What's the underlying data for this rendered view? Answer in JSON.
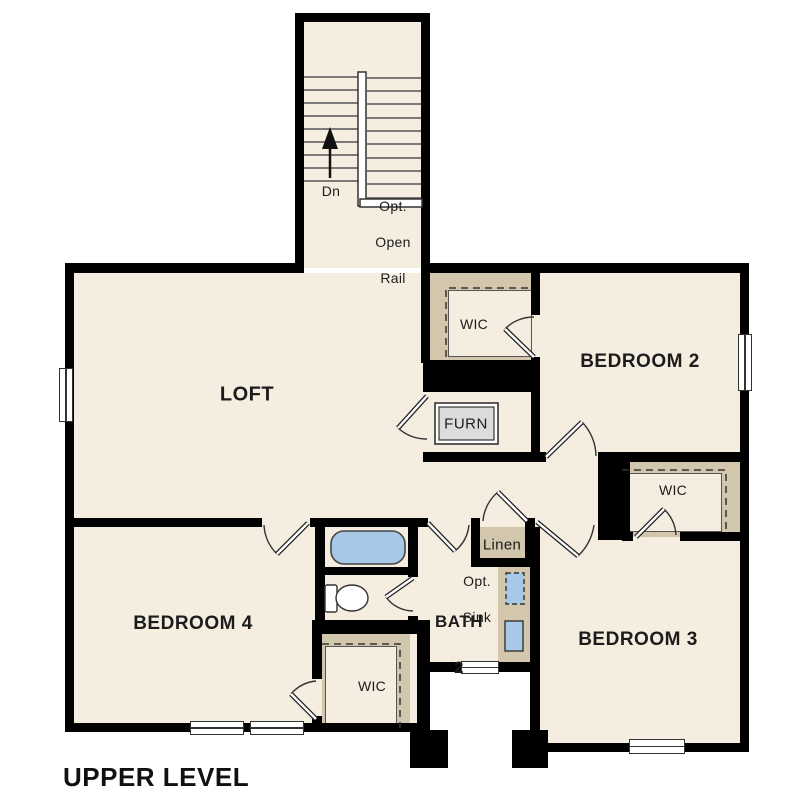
{
  "title": "UPPER LEVEL",
  "rooms": {
    "loft": "LOFT",
    "bedroom2": "BEDROOM 2",
    "bedroom3": "BEDROOM 3",
    "bedroom4": "BEDROOM 4"
  },
  "bath": {
    "line1": "BATH",
    "line2": "2",
    "opt_sink_line1": "Opt.",
    "opt_sink_line2": "Sink"
  },
  "closets": {
    "wic_bedroom2": "WIC",
    "wic_bedroom3": "WIC",
    "wic_bedroom4": "WIC",
    "linen": "Linen",
    "furnace": "FURN"
  },
  "stairs": {
    "down": "Dn",
    "rail_line1": "Opt.",
    "rail_line2": "Open",
    "rail_line3": "Rail"
  },
  "colors": {
    "floor": "#f5ede0",
    "closet": "#d2c6ac",
    "wall": "#000000",
    "fixture_blue": "#a8c8e8",
    "furnace_gray": "#dcdcdc",
    "outline": "#333333"
  }
}
